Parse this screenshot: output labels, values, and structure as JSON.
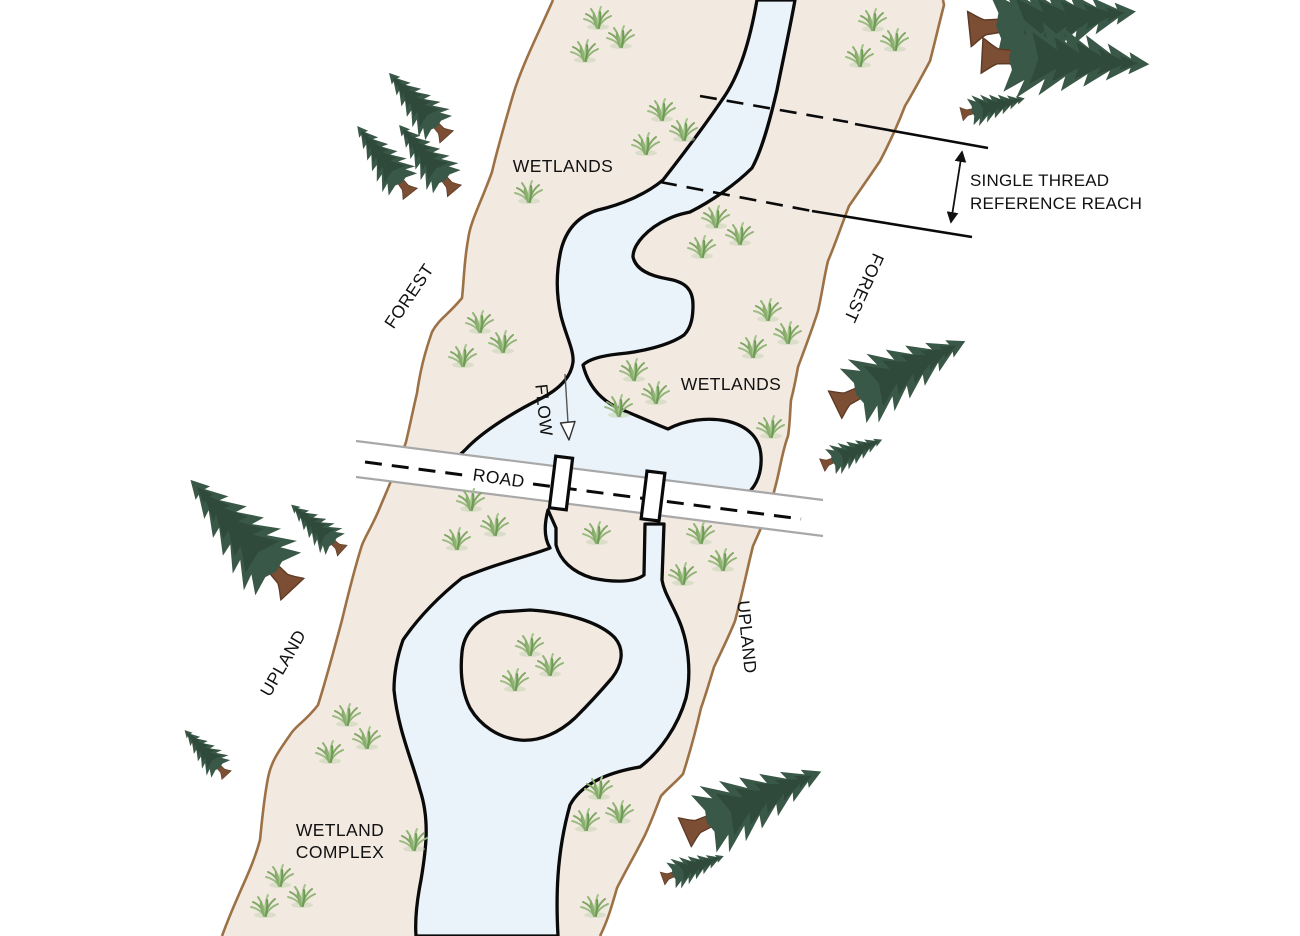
{
  "diagram": {
    "type": "stream-and-wetland-restoration-site-plan",
    "labels": {
      "wetlands_upper": "WETLANDS",
      "forest_left": "FOREST",
      "forest_right": "FOREST",
      "wetlands_mid": "WETLANDS",
      "flow": "FLOW",
      "road": "ROAD",
      "upland_left": "UPLAND",
      "upland_right": "UPLAND",
      "wetland_complex_line1": "WETLAND",
      "wetland_complex_line2": "COMPLEX",
      "reference_reach_line1": "SINGLE THREAD",
      "reference_reach_line2": "REFERENCE REACH"
    }
  },
  "colors": {
    "corridor": "#f2e9e1",
    "water": "#e9f3f9",
    "outline": "#0a0a0a",
    "corridor_border": "#9c7146",
    "road_edge": "#a8a8a8",
    "road_surface": "#ffffff",
    "text": "#111111",
    "tree_foliage": "#3a5847",
    "tree_foliage_dark": "#2c4535",
    "tree_trunk": "#7c4e33",
    "grass_green": "#7fa763"
  },
  "scene": {
    "grass": [
      [
        598,
        28
      ],
      [
        621,
        47
      ],
      [
        585,
        61
      ],
      [
        873,
        30
      ],
      [
        895,
        50
      ],
      [
        860,
        66
      ],
      [
        662,
        120
      ],
      [
        684,
        140
      ],
      [
        646,
        154
      ],
      [
        529,
        202
      ],
      [
        716,
        227
      ],
      [
        740,
        244
      ],
      [
        702,
        257
      ],
      [
        480,
        332
      ],
      [
        503,
        352
      ],
      [
        463,
        366
      ],
      [
        768,
        320
      ],
      [
        788,
        343
      ],
      [
        753,
        357
      ],
      [
        634,
        380
      ],
      [
        656,
        403
      ],
      [
        619,
        416
      ],
      [
        771,
        437
      ],
      [
        471,
        510
      ],
      [
        495,
        535
      ],
      [
        457,
        549
      ],
      [
        597,
        543
      ],
      [
        701,
        543
      ],
      [
        723,
        570
      ],
      [
        683,
        584
      ],
      [
        530,
        655
      ],
      [
        550,
        675
      ],
      [
        515,
        690
      ],
      [
        347,
        725
      ],
      [
        367,
        748
      ],
      [
        330,
        762
      ],
      [
        414,
        850
      ],
      [
        280,
        886
      ],
      [
        302,
        906
      ],
      [
        265,
        916
      ],
      [
        599,
        798
      ],
      [
        620,
        822
      ],
      [
        586,
        830
      ],
      [
        595,
        916
      ]
    ],
    "trees": [
      {
        "x": 417,
        "y": 104,
        "s": 0.95,
        "a": -42
      },
      {
        "x": 383,
        "y": 159,
        "s": 0.95,
        "a": -38
      },
      {
        "x": 426,
        "y": 157,
        "s": 0.95,
        "a": -40
      },
      {
        "x": 1055,
        "y": 20,
        "s": 1.85,
        "a": 84
      },
      {
        "x": 1068,
        "y": 60,
        "s": 1.85,
        "a": 93
      },
      {
        "x": 994,
        "y": 106,
        "s": 0.72,
        "a": 76
      },
      {
        "x": 902,
        "y": 372,
        "s": 1.6,
        "a": 64
      },
      {
        "x": 853,
        "y": 452,
        "s": 0.72,
        "a": 67
      },
      {
        "x": 240,
        "y": 533,
        "s": 1.65,
        "a": -43
      },
      {
        "x": 316,
        "y": 527,
        "s": 0.76,
        "a": -48
      },
      {
        "x": 205,
        "y": 752,
        "s": 0.68,
        "a": -43
      },
      {
        "x": 755,
        "y": 801,
        "s": 1.65,
        "a": 66
      },
      {
        "x": 694,
        "y": 867,
        "s": 0.72,
        "a": 70
      }
    ]
  }
}
